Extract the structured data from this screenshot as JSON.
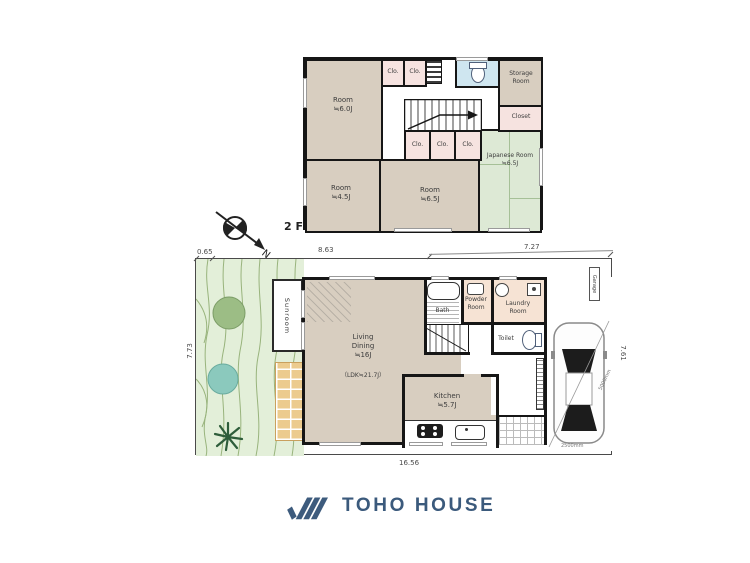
{
  "brand": {
    "name": "TOHO HOUSE"
  },
  "compass": {
    "north_label": "N"
  },
  "floor2": {
    "floor_label": "2 F",
    "room_nw": {
      "name": "Room",
      "size": "≒6.0J"
    },
    "room_sw": {
      "name": "Room",
      "size": "≒4.5J"
    },
    "room_s": {
      "name": "Room",
      "size": "≒6.5J"
    },
    "japanese_room": {
      "name": "Japanese Room",
      "size": "≒6.5J"
    },
    "storage_room": {
      "name": "Storage Room"
    },
    "closet": {
      "name": "Closet"
    },
    "clo_label": "Clo."
  },
  "floor1": {
    "living_dining": {
      "name": "Living Dining",
      "size": "≒16J",
      "ldk_note": "（LDK≒21.7J）"
    },
    "kitchen": {
      "name": "Kitchen",
      "size": "≒5.7J"
    },
    "bath": {
      "name": "Bath"
    },
    "powder_room": {
      "name": "Powder Room"
    },
    "laundry_room": {
      "name": "Laundry Room"
    },
    "toilet": {
      "name": "Toilet"
    },
    "sunroom": {
      "name": "Sunroom"
    },
    "garage": {
      "name": "Garage"
    }
  },
  "dimensions": {
    "top_left": "0.65",
    "top_middle": "8.63",
    "top_right": "7.27",
    "left_side": "7.73",
    "right_side": "7.61",
    "bottom": "16.56",
    "parking_length": "5000mm",
    "parking_width": "2500mm"
  },
  "colors": {
    "brand_blue": "#3b5a7c",
    "room_beige": "#d8cec0",
    "tatami_green": "#dde9d5",
    "closet_pink": "#f6e3e0",
    "garden_green": "#e3efd9",
    "brick_tan": "#eccb8e",
    "water_blue": "#cfe6f0",
    "service_peach": "#f6e3d4"
  }
}
